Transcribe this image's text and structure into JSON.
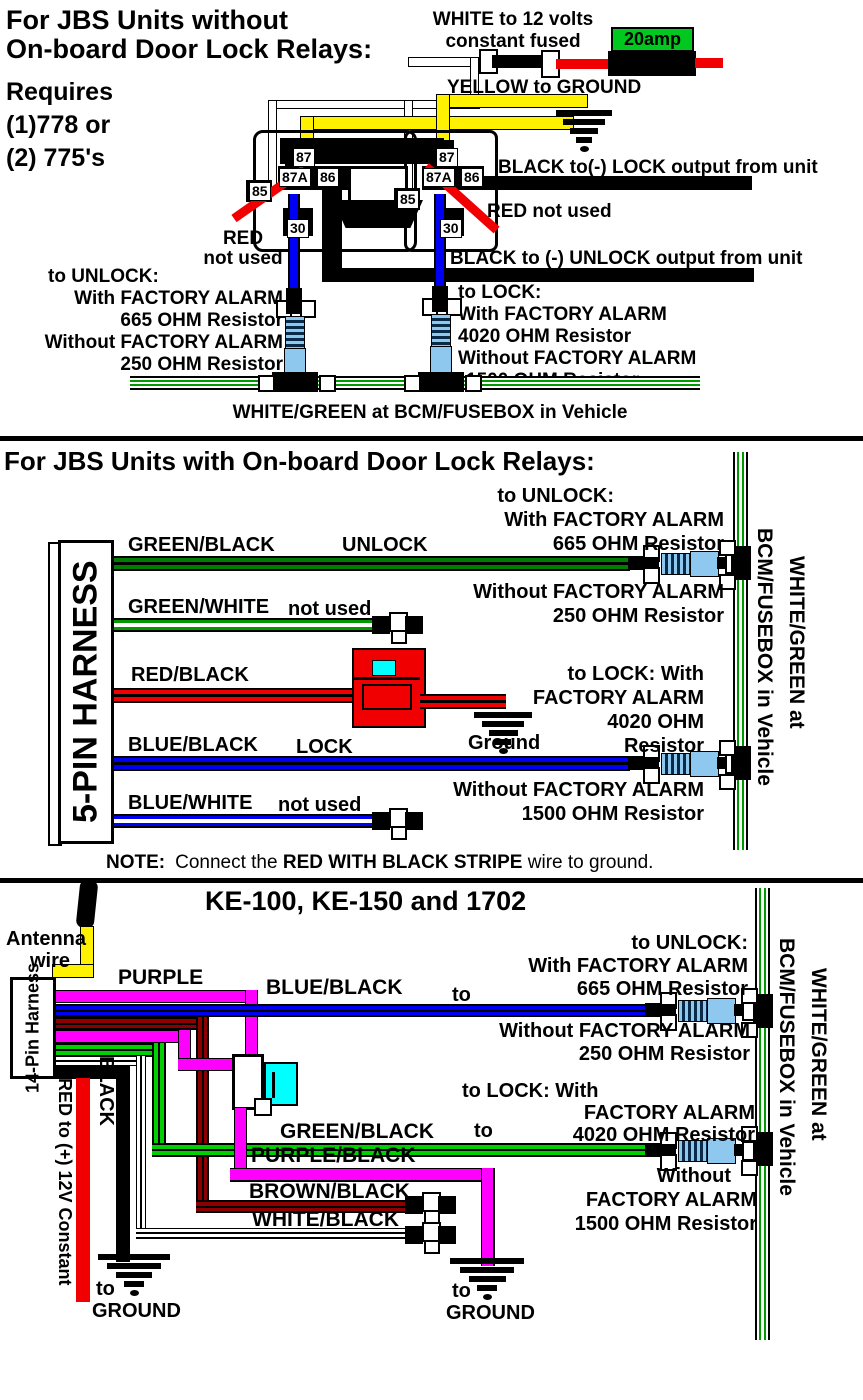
{
  "colors": {
    "yellow": "#FFF200",
    "red": "#F00000",
    "blue": "#0000F5",
    "magenta": "#FF00FF",
    "bright_green": "#00D000",
    "dark_green": "#007C00",
    "dark_red": "#8E0000",
    "resistor_blue": "#8FC8EE",
    "cyan": "#00FFFF",
    "fuse_green": "#00C81E",
    "wire_green": "#009900"
  },
  "s1": {
    "title1": "For JBS Units without",
    "title2": "On-board Door Lock Relays:",
    "req1": "Requires",
    "req2": "(1)778 or",
    "req3": "(2) 775's",
    "white12v1": "WHITE to 12 volts",
    "white12v2": "constant fused",
    "fuse": "20amp",
    "yellow_gnd": "YELLOW to GROUND",
    "pins": [
      "87",
      "87A",
      "86",
      "85",
      "30"
    ],
    "red_nu1": "RED",
    "red_nu2": "not used",
    "red_nu_right": "RED not used",
    "lock_out": "BLACK to(-) LOCK output from unit",
    "unlock_out": "BLACK to (-) UNLOCK output from unit",
    "unlock": [
      "to UNLOCK:",
      "With FACTORY ALARM",
      "665 OHM Resistor",
      "Without FACTORY ALARM",
      "250 OHM Resistor"
    ],
    "lock": [
      "to LOCK:",
      "With FACTORY ALARM",
      "4020 OHM Resistor",
      "Without FACTORY ALARM",
      "1500 OHM Resistor"
    ],
    "caption": "WHITE/GREEN at BCM/FUSEBOX in Vehicle"
  },
  "s2": {
    "title": "For JBS Units with On-board Door Lock Relays:",
    "harness": "5-PIN HARNESS",
    "w_green_black": "GREEN/BLACK",
    "tag_unlock": "UNLOCK",
    "w_green_white": "GREEN/WHITE",
    "tag_nu1": "not used",
    "w_red_black": "RED/BLACK",
    "ground": "Ground",
    "w_blue_black": "BLUE/BLACK",
    "tag_lock": "LOCK",
    "w_blue_white": "BLUE/WHITE",
    "tag_nu2": "not used",
    "unlock": [
      "to UNLOCK:",
      "With FACTORY ALARM",
      "665 OHM Resistor",
      "Without FACTORY ALARM",
      "250 OHM Resistor"
    ],
    "lock": [
      "to LOCK: With",
      "FACTORY ALARM",
      "4020 OHM",
      "Resistor",
      "Without FACTORY ALARM",
      "1500 OHM Resistor"
    ],
    "side1": "WHITE/GREEN at",
    "side2": "BCM/FUSEBOX in Vehicle",
    "note_label": "NOTE:",
    "note_a": "Connect the",
    "note_b": "RED WITH BLACK STRIPE",
    "note_c": "wire to ground."
  },
  "s3": {
    "title": "KE-100, KE-150 and 1702",
    "antenna1": "Antenna",
    "antenna2": "wire",
    "harness1": "14-Pin",
    "harness2": "Harness",
    "purple": "PURPLE",
    "blue_black": "BLUE/BLACK",
    "to1": "to",
    "green_black": "GREEN/BLACK",
    "to2": "to",
    "purple_black": "PURPLE/BLACK",
    "brown_black": "BROWN/BLACK",
    "white_black": "WHITE/BLACK",
    "black_v": "BLACK",
    "red_v": "RED to (+) 12V Constant",
    "gnd_to1": "to",
    "gnd1": "GROUND",
    "gnd_to2": "to",
    "gnd2": "GROUND",
    "unlock": [
      "to UNLOCK:",
      "With FACTORY ALARM",
      "665 OHM Resistor",
      "Without FACTORY ALARM",
      "250 OHM Resistor"
    ],
    "lock": [
      "to LOCK: With",
      "FACTORY ALARM",
      "4020 OHM Resistor",
      "Without",
      "FACTORY ALARM",
      "1500 OHM Resistor"
    ],
    "side1": "WHITE/GREEN at",
    "side2": "BCM/FUSEBOX in Vehicle"
  }
}
